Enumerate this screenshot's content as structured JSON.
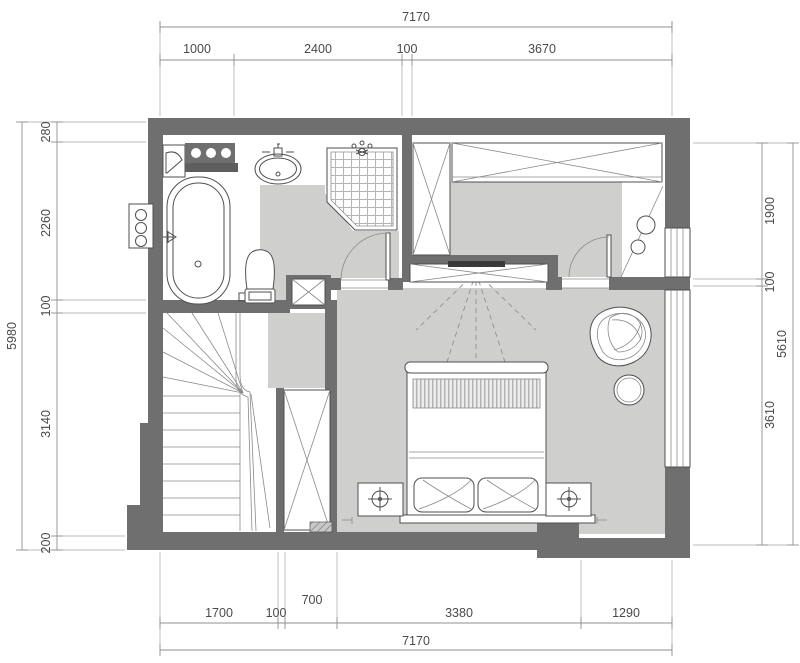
{
  "dimensions": {
    "top": {
      "total": "7170",
      "segments": [
        "1000",
        "2400",
        "100",
        "3670"
      ]
    },
    "bottom": {
      "total": "7170",
      "segments": [
        "1700",
        "100",
        "700",
        "3380",
        "1290"
      ]
    },
    "left": {
      "total": "5980",
      "segments": [
        "280",
        "2260",
        "100",
        "3140",
        "200"
      ]
    },
    "right": {
      "total": "5610",
      "segments": [
        "1900",
        "100",
        "3610"
      ]
    }
  },
  "colors": {
    "wall": "#6f6f6f",
    "floor": "#cfcfce",
    "fixture_line": "#4f4f4f",
    "dim_line": "#8f8f8f",
    "dim_text": "#4a4a4a",
    "background": "#ffffff",
    "tv": "#3a3a3a"
  }
}
